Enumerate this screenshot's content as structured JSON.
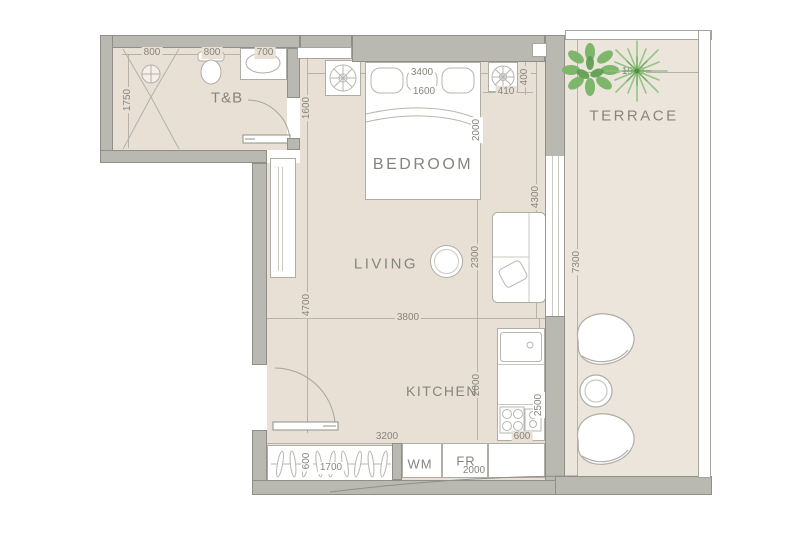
{
  "rooms": {
    "tb": "T&B",
    "bedroom": "BEDROOM",
    "terrace": "TERRACE",
    "living": "LIVING",
    "kitchen": "KITCHEN"
  },
  "appliances": {
    "wm": "WM",
    "fr": "FR"
  },
  "dims": {
    "tb_seg1": "800",
    "tb_seg2": "800",
    "tb_seg3": "700",
    "tb_depth": "1750",
    "bedroom_side": "1600",
    "bedroom_width": "3400",
    "bed_width": "1600",
    "niche_depth": "400",
    "niche_width": "410",
    "bed_length": "2000",
    "bedroom_right": "4300",
    "terrace_width": "1900",
    "terrace_length": "7300",
    "living_side": "4700",
    "living_right": "2300",
    "living_width": "3800",
    "kitchen_side": "2000",
    "kitchen_right": "2500",
    "kitchen_width": "600",
    "hall_width": "3200",
    "closet_depth": "600",
    "closet_width": "1700",
    "appliance_width": "2000"
  },
  "colors": {
    "wall": "#b9b8b1",
    "wall-edge": "#8f8f88",
    "floor": "#e8e0d4",
    "terrace-floor": "#ebe5dc",
    "line": "#b3b2ab",
    "text": "#85857f",
    "plant": "#7ab667",
    "plant-dark": "#5d9c4e"
  }
}
